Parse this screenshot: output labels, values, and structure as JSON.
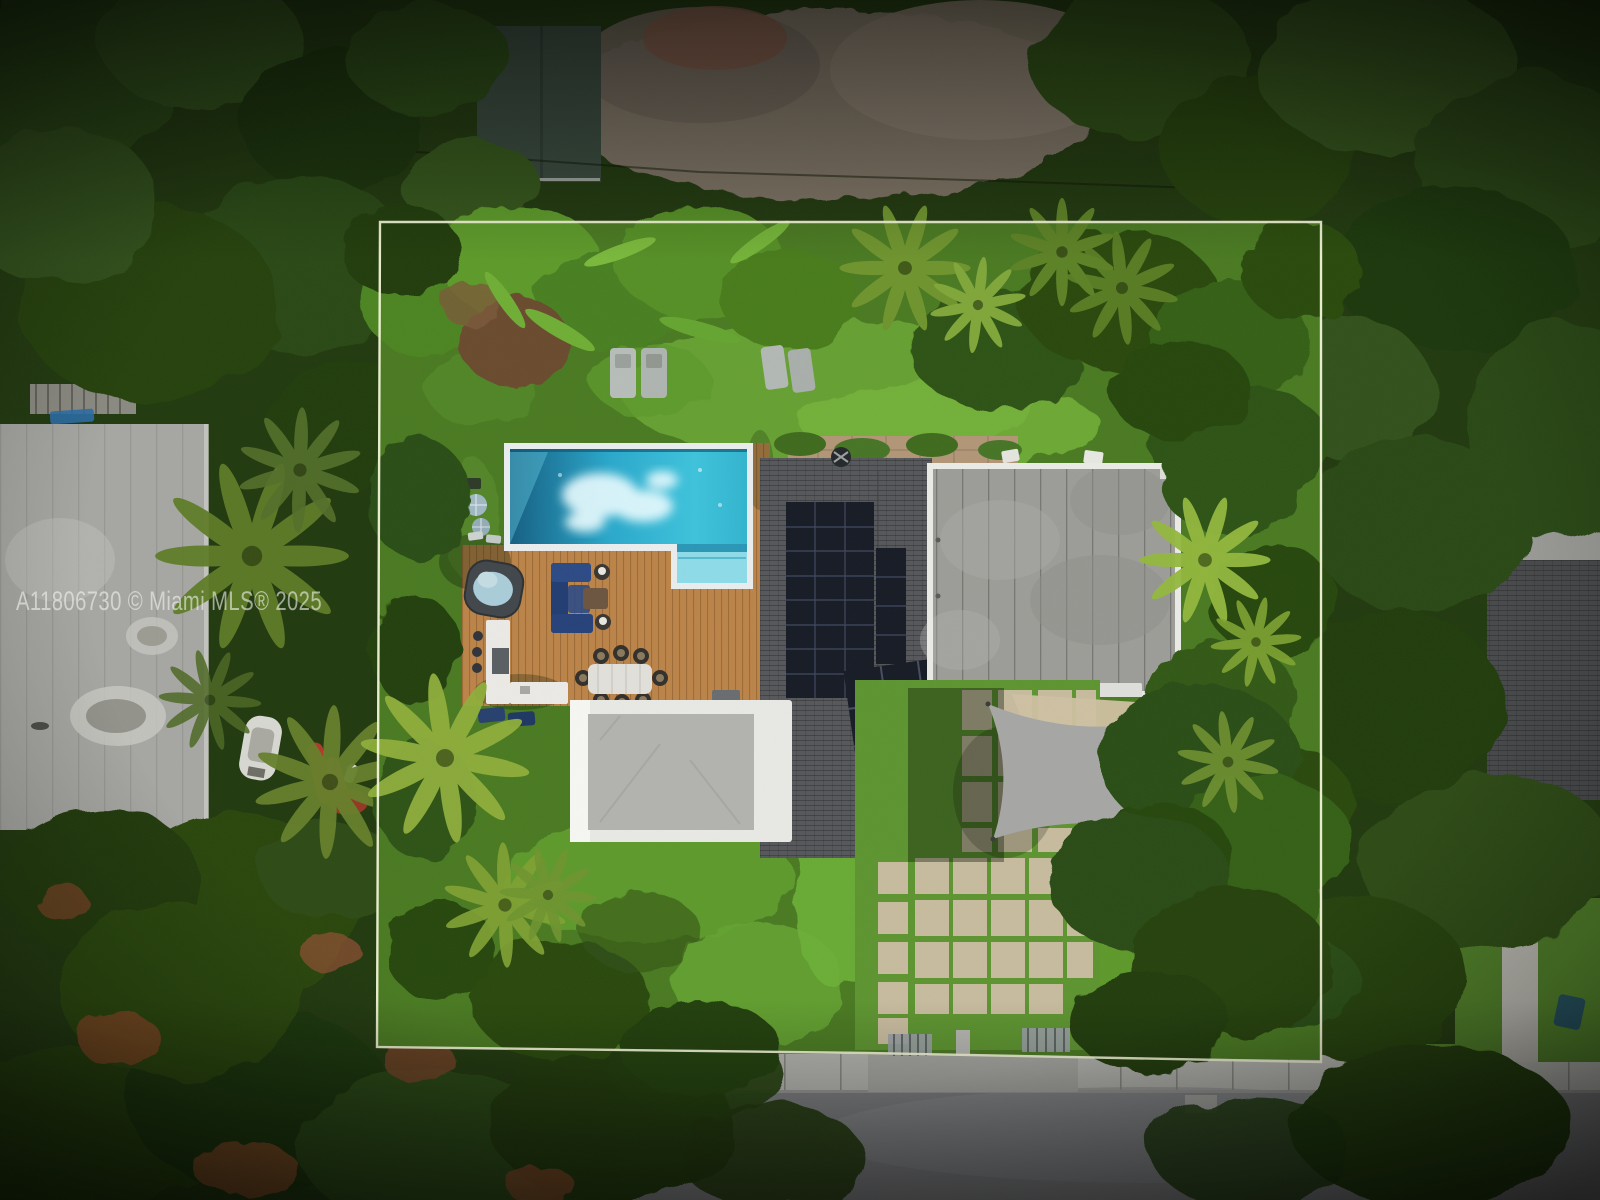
{
  "photo": {
    "type": "aerial-drone-photo",
    "subject": "overhead view of a modern home with pool, wood deck, rooftop solar panels and tropical landscaping, outlined property boundary",
    "watermark": {
      "text": "A11806730 © Miami MLS® 2025",
      "color": "rgba(243,243,239,0.6)"
    },
    "boundary": {
      "color": "#f2f5d7"
    }
  },
  "colors": {
    "canopy": "#223a10",
    "lawn": "#4a7a22",
    "lawn_sunlit": "#6aa434",
    "pool_water_deep": "#155f83",
    "pool_water_bright": "#3ec3dc",
    "pool_coping": "#e9edee",
    "deck_wood": "#bb8449",
    "roof_shingle": "#55575a",
    "solar_panel": "#171b25",
    "roof_concrete": "#9c9c98",
    "roof_white": "#e8e8e4",
    "shade_sail": "#a6a6a4",
    "paver": "#c7bb9e",
    "street": "#7d7e80",
    "sidewalk": "#b3b3ae",
    "neighbor_roof_left": "#a6a6a2",
    "neighbor_roof_right": "#47494b"
  },
  "features": [
    "property-boundary",
    "swimming-pool",
    "sun-shelf",
    "hot-tub",
    "wood-deck",
    "sectional-sofa",
    "dining-set",
    "outdoor-kitchen",
    "sun-loungers",
    "shingle-roof",
    "solar-array",
    "flat-concrete-roof",
    "white-flat-roof",
    "shade-sail",
    "paver-courtyard",
    "trash-bins",
    "driveway-gate",
    "sidewalk",
    "street",
    "neighbor-roof",
    "boat",
    "kayaks",
    "palm-trees"
  ]
}
